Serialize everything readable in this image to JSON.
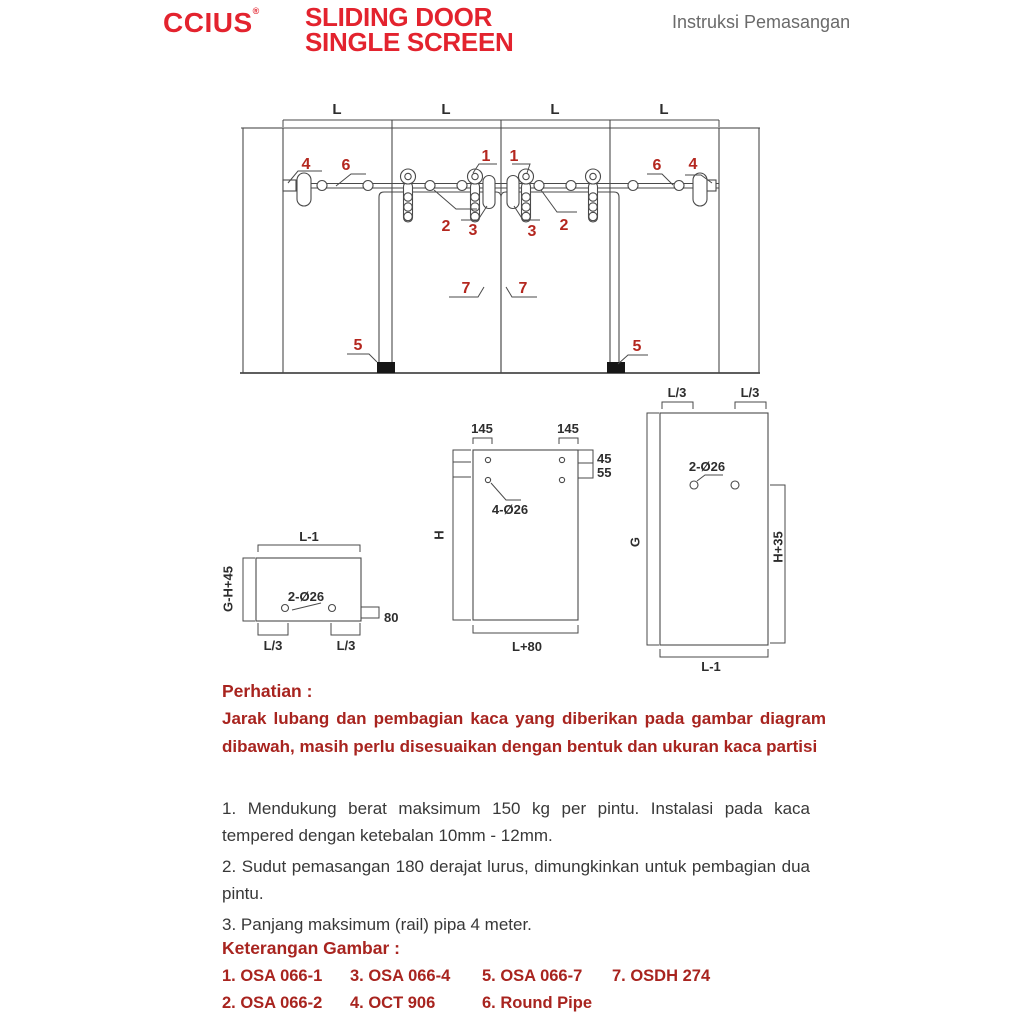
{
  "header": {
    "logo": "CCIUS",
    "logo_mark": "®",
    "title_line1": "SLIDING DOOR",
    "title_line2": "SINGLE SCREEN",
    "subtitle": "Instruksi Pemasangan"
  },
  "colors": {
    "brand_red": "#e3232e",
    "text_red": "#a8241f",
    "callout_red": "#b4271f",
    "diagram_line": "#4a4a4a",
    "subtitle_gray": "#6a6a6a"
  },
  "main_diagram": {
    "span_labels": [
      "L",
      "L",
      "L",
      "L"
    ],
    "callouts": {
      "n4l": "4",
      "n6l": "6",
      "n1a": "1",
      "n1b": "1",
      "n2l": "2",
      "n3l": "3",
      "n3r": "3",
      "n2r": "2",
      "n6r": "6",
      "n4r": "4",
      "n7l": "7",
      "n7r": "7",
      "n5l": "5",
      "n5r": "5"
    }
  },
  "fig1": {
    "top": "L-1",
    "left": "G-H+45",
    "holes": "2-Ø26",
    "right": "80",
    "bottom_left": "L/3",
    "bottom_right": "L/3"
  },
  "fig2": {
    "top_left": "145",
    "top_right": "145",
    "right_top": "45",
    "right_bottom": "55",
    "left": "H",
    "holes": "4-Ø26",
    "bottom": "L+80"
  },
  "fig3": {
    "top_left": "L/3",
    "top_right": "L/3",
    "left": "G",
    "holes": "2-Ø26",
    "right": "H+35",
    "bottom": "L-1"
  },
  "notes": {
    "heading": "Perhatian :",
    "warning": "Jarak lubang dan pembagian kaca yang diberikan pada gambar diagram dibawah, masih perlu disesuaikan dengan bentuk dan ukuran kaca partisi",
    "item1": "1. Mendukung berat maksimum 150 kg per pintu. Instalasi pada kaca tempered dengan ketebalan 10mm - 12mm.",
    "item2": "2. Sudut pemasangan 180 derajat lurus, dimungkinkan untuk pembagian dua pintu.",
    "item3": "3. Panjang maksimum (rail) pipa 4 meter."
  },
  "legend": {
    "heading": "Keterangan Gambar :",
    "items": [
      "1. OSA 066-1",
      "2. OSA 066-2",
      "3. OSA 066-4",
      "4. OCT 906",
      "5. OSA 066-7",
      "6. Round Pipe",
      "7. OSDH 274"
    ]
  }
}
